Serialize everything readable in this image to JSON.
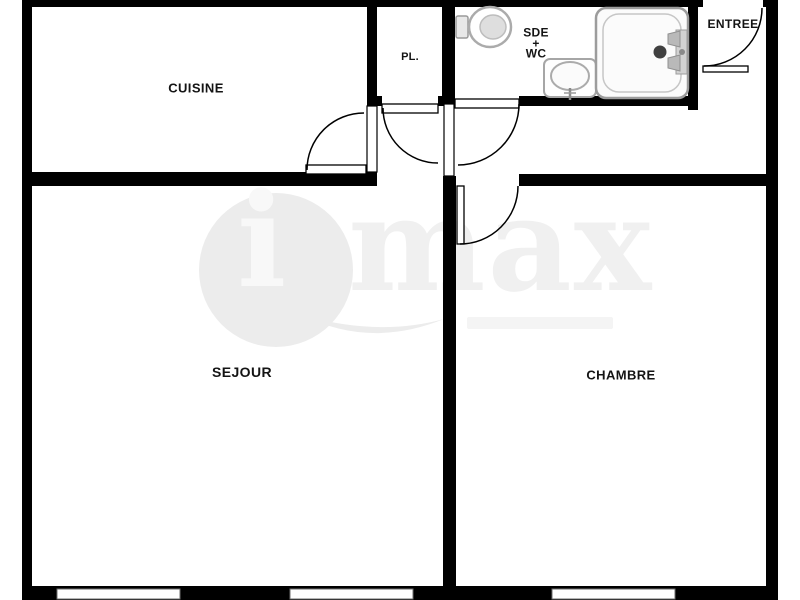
{
  "plan_title": "apartment-floor-plan",
  "rooms": {
    "cuisine": {
      "label": "CUISINE"
    },
    "pl": {
      "label": "PL."
    },
    "sde": {
      "line1": "SDE",
      "line2": "+",
      "line3": "WC"
    },
    "entree": {
      "label": "ENTREE"
    },
    "sejour": {
      "label": "SEJOUR"
    },
    "chambre": {
      "label": "CHAMBRE"
    }
  },
  "watermark": {
    "letter": "i",
    "word": "max"
  },
  "fixtures": {
    "toilet": "toilet-icon",
    "washbasin": "washbasin-icon",
    "shower": "shower-tray-icon"
  },
  "counts": {
    "windows": 3,
    "doors": 5
  },
  "colors": {
    "wall": "#000000",
    "background": "#ffffff",
    "fixture_outline": "#a6a6a6",
    "drain": "#404040",
    "watermark": "#ececec",
    "label_text": "#141414"
  }
}
